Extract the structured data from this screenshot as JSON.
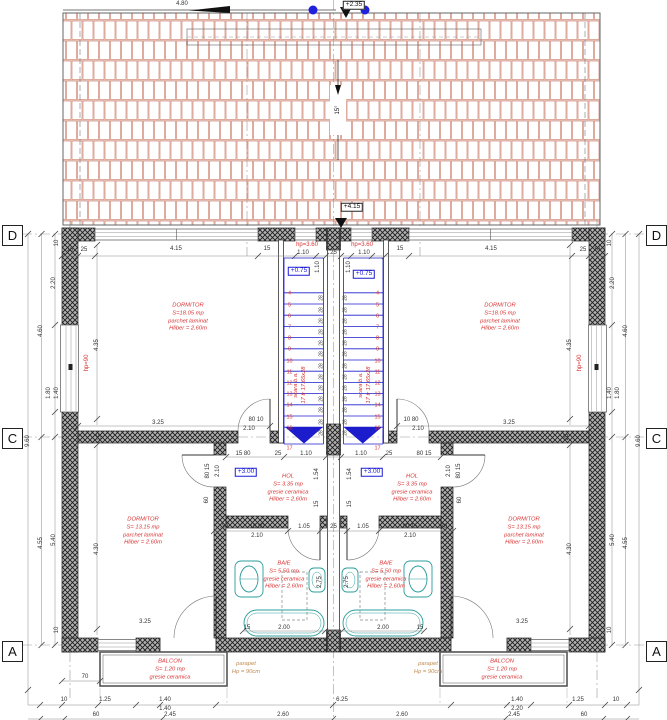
{
  "title": "Etaj - plan (duplex floor plan)",
  "colors": {
    "dim": "#333333",
    "red": "#d93434",
    "blue": "#1b1bd6",
    "teal": "#2a9d9b",
    "orange": "#c08a4e",
    "roof": "#c2664f",
    "wall": "#1e1e1e"
  },
  "grid": {
    "rows": [
      "D",
      "C",
      "A"
    ]
  },
  "roof": {
    "slope": "15°",
    "top_dim": "4.80",
    "level_top": "+2.35",
    "level_eave": "+4.15"
  },
  "stairs": {
    "first": 4,
    "last": 17,
    "count": 13,
    "riser": "28",
    "yFirst": 292.8,
    "dy": 11.2,
    "lastY": 449,
    "left": {
      "x0": 284,
      "x1": 323.5,
      "numX": 289.5,
      "rX": 321.5
    },
    "right": {
      "x0": 343.5,
      "x1": 383,
      "numX": 377.5,
      "rX": 345.5
    }
  },
  "rooms": [
    {
      "n": "room-dormitor-top-left",
      "cx": 188,
      "cy": 318,
      "lines": [
        "DORMITOR",
        "S=18.05 mp",
        "parchet laminat",
        "Hliber = 2.60m"
      ]
    },
    {
      "n": "room-dormitor-top-right",
      "cx": 500,
      "cy": 318,
      "lines": [
        "DORMITOR",
        "S=18.05 mp",
        "parchet laminat",
        "Hliber = 2.60m"
      ]
    },
    {
      "n": "room-dormitor-bottom-left",
      "cx": 143,
      "cy": 532,
      "lines": [
        "DORMITOR",
        "S= 13.15 mp",
        "parchet laminat",
        "Hliber = 2.60m"
      ]
    },
    {
      "n": "room-dormitor-bottom-right",
      "cx": 524,
      "cy": 532,
      "lines": [
        "DORMITOR",
        "S= 13.15 mp",
        "parchet laminat",
        "Hliber = 2.60m"
      ]
    },
    {
      "n": "room-hol-left",
      "cx": 288,
      "cy": 489,
      "lines": [
        "HOL",
        "S= 3.35 mp",
        "gresie ceramica",
        "Hliber = 2.60m"
      ]
    },
    {
      "n": "room-hol-right",
      "cx": 412,
      "cy": 489,
      "lines": [
        "HOL",
        "S= 3.35 mp",
        "gresie ceramica",
        "Hliber = 2.60m"
      ]
    },
    {
      "n": "room-baie-left",
      "cx": 284,
      "cy": 576,
      "lines": [
        "BAIE",
        "S= 5.50 mp",
        "gresie ceramica",
        "Hliber = 2.60m"
      ]
    },
    {
      "n": "room-baie-right",
      "cx": 386,
      "cy": 576,
      "lines": [
        "BAIE",
        "S= 5.50 mp",
        "gresie ceramica",
        "Hliber = 2.60m"
      ]
    },
    {
      "n": "room-balcon-left",
      "cx": 170,
      "cy": 670,
      "lines": [
        "BALCON",
        "S= 1.20 mp",
        "gresie ceramica"
      ]
    },
    {
      "n": "room-balcon-right",
      "cx": 502,
      "cy": 670,
      "lines": [
        "BALCON",
        "S= 1.20 mp",
        "gresie ceramica"
      ]
    },
    {
      "n": "note-parapet-left",
      "cx": 246,
      "cy": 669,
      "cls": "orange",
      "lines": [
        "parapet",
        "Hp = 90cm"
      ]
    },
    {
      "n": "note-parapet-right",
      "cx": 428,
      "cy": 669,
      "cls": "orange",
      "lines": [
        "parapet",
        "Hp = 90cm"
      ]
    },
    {
      "n": "note-stair-left",
      "cx": 301,
      "cy": 385,
      "rot": 1,
      "lines": [
        "scara b.a.",
        "17 tr 17.65x28"
      ]
    },
    {
      "n": "note-stair-right",
      "cx": 366,
      "cy": 385,
      "rot": 1,
      "lines": [
        "scara b.a.",
        "17 tr 17.65x28"
      ]
    }
  ],
  "labels": [
    {
      "t": "4.80",
      "x": 182,
      "y": 4
    },
    {
      "t": "+2.35",
      "x": 354,
      "y": 5,
      "c": "k",
      "b": 1,
      "n": "level-ridge"
    },
    {
      "t": "+4.15",
      "x": 352,
      "y": 207,
      "c": "k",
      "b": 1,
      "n": "level-eave"
    },
    {
      "t": "15°",
      "x": 338,
      "y": 110,
      "r": 1,
      "c": "k",
      "n": "roof-slope"
    },
    {
      "t": "hp=3.60",
      "x": 307,
      "y": 245,
      "c": "red"
    },
    {
      "t": "hp=3.60",
      "x": 362,
      "y": 245,
      "c": "red"
    },
    {
      "t": "+0.75",
      "x": 299,
      "y": 271,
      "c": "blue",
      "b": 1,
      "n": "level-stair-left"
    },
    {
      "t": "+0.75",
      "x": 364,
      "y": 274,
      "c": "blue",
      "b": 1,
      "n": "level-stair-right"
    },
    {
      "t": "+3.00",
      "x": 246,
      "y": 472,
      "c": "blue",
      "b": 1,
      "n": "level-hol-left"
    },
    {
      "t": "+3.00",
      "x": 372,
      "y": 472,
      "c": "blue",
      "b": 1,
      "n": "level-hol-right"
    },
    {
      "t": "hp=90",
      "x": 87,
      "y": 363,
      "r": 1,
      "c": "red"
    },
    {
      "t": "hp=90",
      "x": 580,
      "y": 363,
      "r": 1,
      "c": "red"
    },
    {
      "t": "10",
      "x": 70,
      "y": 250
    },
    {
      "t": "25",
      "x": 84,
      "y": 250
    },
    {
      "t": "4.15",
      "x": 176,
      "y": 249
    },
    {
      "t": "15",
      "x": 267,
      "y": 249
    },
    {
      "t": "1.10",
      "x": 303,
      "y": 253
    },
    {
      "t": "25",
      "x": 333.5,
      "y": 253
    },
    {
      "t": "1.10",
      "x": 364,
      "y": 253
    },
    {
      "t": "15",
      "x": 400,
      "y": 249
    },
    {
      "t": "4.15",
      "x": 491,
      "y": 249
    },
    {
      "t": "25",
      "x": 583,
      "y": 250
    },
    {
      "t": "10",
      "x": 597,
      "y": 250
    },
    {
      "t": "1.10",
      "x": 318,
      "y": 267,
      "r": 1
    },
    {
      "t": "1.10",
      "x": 349,
      "y": 267,
      "r": 1
    },
    {
      "t": "10",
      "x": 57,
      "y": 243,
      "r": 1
    },
    {
      "t": "2.20",
      "x": 54,
      "y": 283,
      "r": 1
    },
    {
      "t": "4.60",
      "x": 41,
      "y": 331,
      "r": 1
    },
    {
      "t": "1.80",
      "x": 49,
      "y": 393,
      "r": 1
    },
    {
      "t": "1.40",
      "x": 57,
      "y": 393,
      "r": 1
    },
    {
      "t": "9.60",
      "x": 28,
      "y": 441,
      "r": 1
    },
    {
      "t": "4.55",
      "x": 41,
      "y": 543,
      "r": 1
    },
    {
      "t": "5.40",
      "x": 54,
      "y": 540,
      "r": 1
    },
    {
      "t": "10",
      "x": 57,
      "y": 630,
      "r": 1
    },
    {
      "t": "10",
      "x": 610,
      "y": 243,
      "r": 1
    },
    {
      "t": "2.20",
      "x": 613,
      "y": 283,
      "r": 1
    },
    {
      "t": "4.60",
      "x": 626,
      "y": 331,
      "r": 1
    },
    {
      "t": "1.80",
      "x": 618,
      "y": 393,
      "r": 1
    },
    {
      "t": "1.40",
      "x": 610,
      "y": 393,
      "r": 1
    },
    {
      "t": "9.60",
      "x": 639,
      "y": 441,
      "r": 1
    },
    {
      "t": "4.55",
      "x": 626,
      "y": 543,
      "r": 1
    },
    {
      "t": "5.40",
      "x": 613,
      "y": 540,
      "r": 1
    },
    {
      "t": "10",
      "x": 610,
      "y": 630,
      "r": 1
    },
    {
      "t": "4.35",
      "x": 97,
      "y": 345,
      "r": 1
    },
    {
      "t": "4.35",
      "x": 570,
      "y": 345,
      "r": 1
    },
    {
      "t": "4.30",
      "x": 97,
      "y": 549,
      "r": 1
    },
    {
      "t": "4.30",
      "x": 570,
      "y": 549,
      "r": 1
    },
    {
      "t": "3.25",
      "x": 158,
      "y": 423
    },
    {
      "t": "3.25",
      "x": 509,
      "y": 423
    },
    {
      "t": "80 10",
      "x": 256,
      "y": 420
    },
    {
      "t": "10 80",
      "x": 411,
      "y": 420
    },
    {
      "t": "2.10",
      "x": 249,
      "y": 429
    },
    {
      "t": "2.10",
      "x": 418,
      "y": 429
    },
    {
      "t": "25",
      "x": 100,
      "y": 437,
      "r": 1
    },
    {
      "t": "25",
      "x": 567,
      "y": 437,
      "r": 1
    },
    {
      "t": "15 80",
      "x": 243,
      "y": 454
    },
    {
      "t": "25",
      "x": 278,
      "y": 454
    },
    {
      "t": "1.10",
      "x": 306,
      "y": 454
    },
    {
      "t": "1.10",
      "x": 361,
      "y": 454
    },
    {
      "t": "25",
      "x": 389,
      "y": 454
    },
    {
      "t": "80 15",
      "x": 424,
      "y": 454
    },
    {
      "t": "80 15",
      "x": 208,
      "y": 471,
      "r": 1
    },
    {
      "t": "2.10",
      "x": 218,
      "y": 471,
      "r": 1
    },
    {
      "t": "80 15",
      "x": 459,
      "y": 471,
      "r": 1
    },
    {
      "t": "2.10",
      "x": 449,
      "y": 471,
      "r": 1
    },
    {
      "t": "1.54",
      "x": 317,
      "y": 474,
      "r": 1
    },
    {
      "t": "1.54",
      "x": 350,
      "y": 474,
      "r": 1
    },
    {
      "t": "15",
      "x": 317,
      "y": 504,
      "r": 1
    },
    {
      "t": "15",
      "x": 350,
      "y": 504,
      "r": 1
    },
    {
      "t": ".30",
      "x": 224,
      "y": 527
    },
    {
      "t": "15 80",
      "x": 257,
      "y": 527
    },
    {
      "t": "1.05",
      "x": 304,
      "y": 527
    },
    {
      "t": "25",
      "x": 333.5,
      "y": 527
    },
    {
      "t": "1.05",
      "x": 363,
      "y": 527
    },
    {
      "t": "80 15",
      "x": 410,
      "y": 527
    },
    {
      "t": ".30",
      "x": 443,
      "y": 527
    },
    {
      "t": "2.10",
      "x": 257,
      "y": 536
    },
    {
      "t": "2.10",
      "x": 410,
      "y": 536
    },
    {
      "t": "60",
      "x": 207,
      "y": 500,
      "r": 1
    },
    {
      "t": "60",
      "x": 460,
      "y": 500,
      "r": 1
    },
    {
      "t": "2.75",
      "x": 320,
      "y": 582,
      "r": 1
    },
    {
      "t": "2.75",
      "x": 347,
      "y": 582,
      "r": 1
    },
    {
      "t": "15",
      "x": 247,
      "y": 628
    },
    {
      "t": "2.00",
      "x": 284,
      "y": 628
    },
    {
      "t": "2.00",
      "x": 383,
      "y": 628
    },
    {
      "t": "15",
      "x": 420,
      "y": 628
    },
    {
      "t": "3.25",
      "x": 145,
      "y": 622
    },
    {
      "t": "3.25",
      "x": 522,
      "y": 622
    },
    {
      "t": "70",
      "x": 85,
      "y": 677
    },
    {
      "t": "10",
      "x": 64,
      "y": 700
    },
    {
      "t": "1.25",
      "x": 105,
      "y": 700
    },
    {
      "t": "1.40",
      "x": 165,
      "y": 700
    },
    {
      "t": "6.25",
      "x": 342,
      "y": 700
    },
    {
      "t": "1.40",
      "x": 517,
      "y": 700
    },
    {
      "t": "1.25",
      "x": 578,
      "y": 700
    },
    {
      "t": "10",
      "x": 616,
      "y": 700
    },
    {
      "t": "1.40",
      "x": 165,
      "y": 709
    },
    {
      "t": "2.20",
      "x": 517,
      "y": 709
    },
    {
      "t": "60",
      "x": 96,
      "y": 715
    },
    {
      "t": "2.45",
      "x": 170,
      "y": 715
    },
    {
      "t": "2.60",
      "x": 283,
      "y": 715
    },
    {
      "t": "2.60",
      "x": 402,
      "y": 715
    },
    {
      "t": "2.45",
      "x": 514,
      "y": 715
    },
    {
      "t": "60",
      "x": 584,
      "y": 715
    }
  ]
}
